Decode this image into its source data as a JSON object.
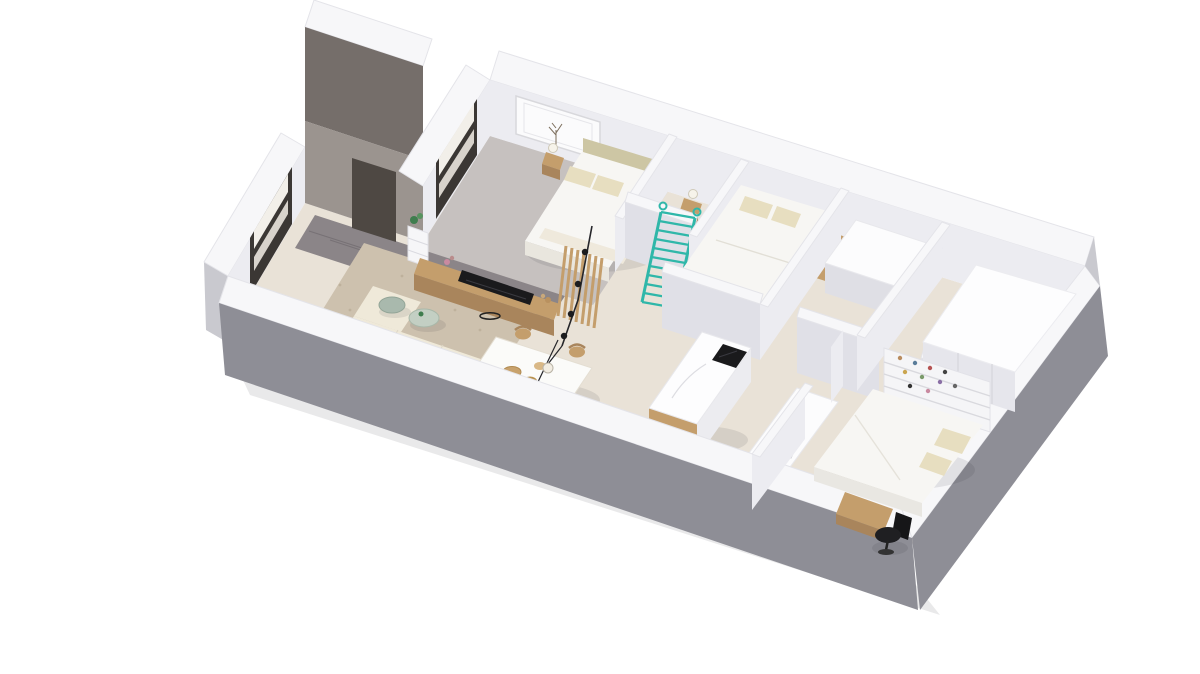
{
  "scene": {
    "type": "3d-floor-plan-render",
    "description": "Isometric 3D render of a furnished apartment floor plan viewed from above at an angle, floating on a white background",
    "style": "architectural visualization, white walls, beige floors"
  },
  "colors": {
    "background": "#ffffff",
    "wall_top": "#f7f7f9",
    "wall_edge": "#e4e4e9",
    "wall_face_light": "#ececf1",
    "wall_face_mid": "#e0e0e7",
    "wall_exterior_shadow": "#8e8e96",
    "wall_exterior_light": "#c9c9cf",
    "tall_wall_dark": "#756e6a",
    "tall_wall_mid": "#9b948f",
    "door_dark": "#4e4843",
    "floor_main": "#e9e2d7",
    "floor_carpet": "#c6c1bf",
    "floor_tiles": "#8b8588",
    "rug": "#cdc1ae",
    "rug_speckle": "#b3a48e",
    "wood": "#c49e6c",
    "wood_dark": "#a9855c",
    "teal": "#2fb7a9",
    "black": "#1a1a1c",
    "linen": "#f7f6f3",
    "cream": "#efe9d9",
    "cream_dark": "#e6e1d3",
    "pillow": "#e7dec0",
    "headboard": "#cdc6a4",
    "plant_green": "#3f7d4e",
    "table_green": "#a9b9ad",
    "table_green_2": "#c3cfc3",
    "window_frame": "#3b3734",
    "window_glass": "#f2efe9",
    "window_glass_dim": "#d8d3cc"
  },
  "rooms": [
    {
      "name": "living-room",
      "furniture": [
        "corner-sofa",
        "area-rug",
        "round-coffee-tables",
        "tv-console",
        "tv",
        "slat-partition",
        "entry-shelf",
        "plant"
      ]
    },
    {
      "name": "dining-area",
      "furniture": [
        "dining-table",
        "four-wood-chairs",
        "bowls",
        "pendant-lights"
      ]
    },
    {
      "name": "master-bedroom",
      "furniture": [
        "double-bed",
        "headboard",
        "two-nightstands",
        "lamps",
        "framed-picture",
        "window"
      ]
    },
    {
      "name": "bedroom-2",
      "furniture": [
        "double-bed",
        "pillows",
        "wood-shelf"
      ]
    },
    {
      "name": "kitchen",
      "furniture": [
        "island-with-cooktop",
        "sink-counter",
        "wall-counter"
      ]
    },
    {
      "name": "bedroom-3",
      "furniture": [
        "double-bed",
        "pillows",
        "shelving-unit",
        "desk",
        "office-chair"
      ]
    },
    {
      "name": "hallway",
      "furniture": [
        "teal-ladder",
        "entry-tiles",
        "entry-door"
      ]
    },
    {
      "name": "storage-room",
      "furniture": [
        "white-closets"
      ]
    }
  ],
  "features": [
    "teal-accent-ladder",
    "two-dark-framed-windows",
    "dark-entry-doorway",
    "double-height-entry-wall",
    "picture-frame-with-tree-art",
    "black-pendant-string-lights"
  ]
}
